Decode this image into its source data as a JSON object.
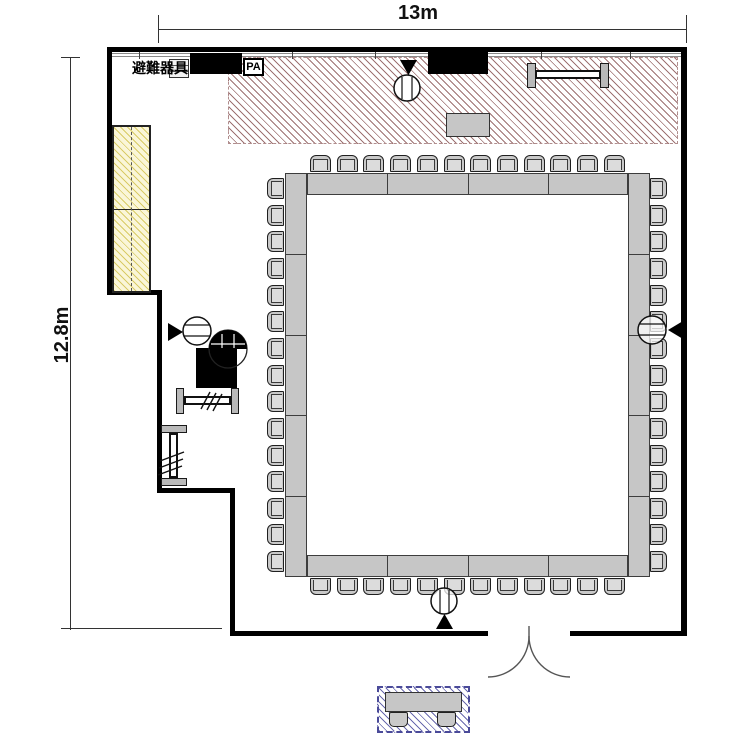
{
  "floor_plan": {
    "dimensions": {
      "width_label": "13m",
      "height_label": "12.8m"
    },
    "labels": {
      "evacuation_equipment": "避難器具",
      "pa_system": "PA"
    },
    "colors": {
      "wall": "#000000",
      "stage_hatch": "#9e7272",
      "cabinet_fill": "#faf6d8",
      "cabinet_hatch": "#d9cb66",
      "reception_hatch": "#6a6aae",
      "table_fill": "#c6c6c6",
      "chair_fill": "#c9c9c9"
    },
    "seating": {
      "arrangement": "hollow-square",
      "sides": {
        "top": {
          "chairs": 12,
          "table_segments": 4
        },
        "bottom": {
          "chairs": 12,
          "table_segments": 4
        },
        "left": {
          "chairs": 15,
          "table_segments": 5
        },
        "right": {
          "chairs": 15,
          "table_segments": 5
        }
      },
      "total_chairs": 54
    },
    "speakers": [
      {
        "location": "stage-top",
        "facing": "down"
      },
      {
        "location": "left-wall",
        "facing": "right"
      },
      {
        "location": "right-side",
        "facing": "left"
      },
      {
        "location": "bottom",
        "facing": "up"
      }
    ],
    "reception": {
      "tables": 1,
      "chairs": 2
    },
    "door": {
      "type": "double-swing",
      "location": "bottom"
    }
  }
}
